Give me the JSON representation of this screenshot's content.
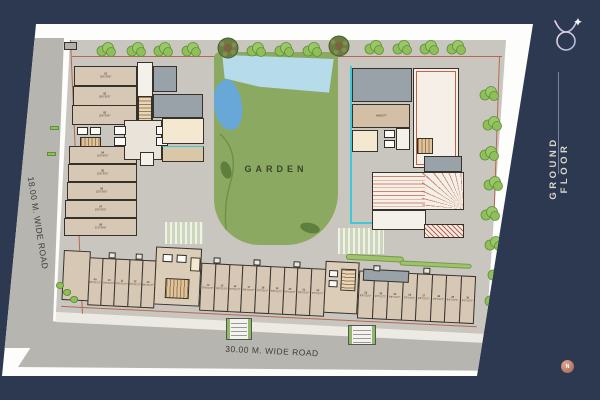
{
  "frame": {
    "title": "GROUND FLOOR",
    "compass_letter": "N",
    "logo_icon": "taurus-logo-icon",
    "north_arrow_glyph": "↑"
  },
  "roads": {
    "left_label": "18.00 M. WIDE ROAD",
    "bottom_label": "30.00 M. WIDE ROAD"
  },
  "garden": {
    "label": "GARDEN"
  },
  "left_shops": [
    {
      "num": "01",
      "dims": "18'6\"X9'6\""
    },
    {
      "num": "02",
      "dims": "18'6\"X9'0\""
    },
    {
      "num": "03",
      "dims": "18'6\"X9'6\""
    },
    {
      "num": "04",
      "dims": "19'0\"X9'0\""
    },
    {
      "num": "05",
      "dims": "19'6\"X9'0\""
    },
    {
      "num": "06",
      "dims": "20'0\"X9'0\""
    },
    {
      "num": "07",
      "dims": "20'6\"X9'0\""
    },
    {
      "num": "08",
      "dims": "21'0\"X9'6\""
    }
  ],
  "bottom_shops": [
    {
      "num": "09",
      "dims": "8'6\"X12'2\""
    },
    {
      "num": "10",
      "dims": "9'0\"X12'2\""
    },
    {
      "num": "11",
      "dims": "8'6\"X12'2\""
    },
    {
      "num": "12",
      "dims": "9'0\"X12'2\""
    },
    {
      "num": "13",
      "dims": "8'6\"X12'2\""
    },
    {
      "num": "14",
      "dims": "9'0\"X12'2\""
    },
    {
      "num": "15",
      "dims": "8'6\"X12'2\""
    },
    {
      "num": "16",
      "dims": "9'0\"X12'2\""
    },
    {
      "num": "17",
      "dims": "8'6\"X12'2\""
    },
    {
      "num": "18",
      "dims": "9'0\"X12'2\""
    },
    {
      "num": "19",
      "dims": "8'6\"X12'2\""
    },
    {
      "num": "20",
      "dims": "9'0\"X12'2\""
    },
    {
      "num": "21",
      "dims": "8'6\"X12'2\""
    },
    {
      "num": "22",
      "dims": "9'0\"X12'2\""
    },
    {
      "num": "23",
      "dims": "8'6\"X12'2\""
    },
    {
      "num": "24",
      "dims": "9'0\"X12'2\""
    },
    {
      "num": "25",
      "dims": "8'6\"X12'2\""
    },
    {
      "num": "26",
      "dims": "9'0\"X12'2\""
    },
    {
      "num": "27",
      "dims": "8'6\"X12'2\""
    },
    {
      "num": "28",
      "dims": "9'0\"X12'2\""
    },
    {
      "num": "29",
      "dims": "8'6\"X12'2\""
    },
    {
      "num": "30",
      "dims": "9'6\"X12'2\""
    }
  ],
  "colors": {
    "background_navy": "#2c3951",
    "sheet_white": "#fdfdfb",
    "road_gray": "#b7b5af",
    "site_gray": "#c9c6c0",
    "garden_green": "#8ba961",
    "water_light": "#b6dcec",
    "water_dark": "#68a8d8",
    "shop_tan": "#d7c7b5",
    "room_gray": "#99a2a8",
    "room_cream": "#f4e9d0",
    "stair_brown": "#a07c50",
    "hatch_red": "#c0614a",
    "tree_green": "#8fbf59",
    "tree_dark": "#6a7d41",
    "accent_cyan": "#43c6d8",
    "title_text": "#dcd7cc",
    "compass_rose": "#9c5f4f"
  }
}
